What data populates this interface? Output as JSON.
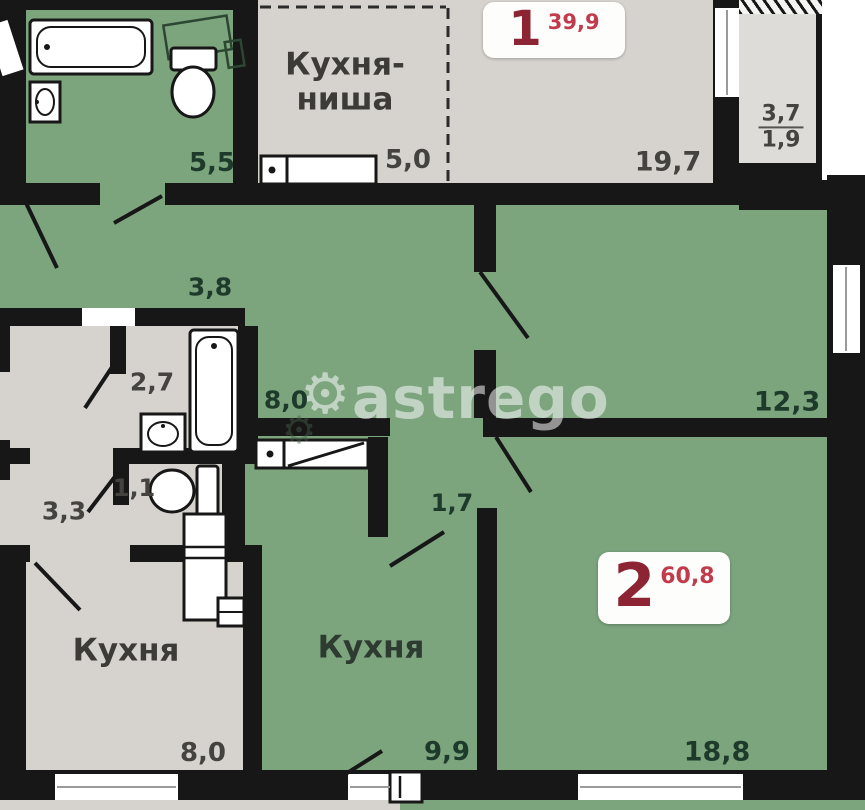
{
  "plan_type": "apartment-floor-plan",
  "apartments": {
    "apt1": {
      "number": "1",
      "area": "39,9"
    },
    "apt2": {
      "number": "2",
      "area": "60,8"
    }
  },
  "rooms": {
    "bath_top": {
      "area": "5,5"
    },
    "kitchen_niche": {
      "label": "Кухня-ниша",
      "area": "5,0"
    },
    "living_197": {
      "area": "19,7"
    },
    "balcony": {
      "area_top": "3,7",
      "area_bottom": "1,9"
    },
    "hall_38": {
      "area": "3,8"
    },
    "bath_27": {
      "area": "2,7"
    },
    "hall_80": {
      "area": "8,0"
    },
    "room_123": {
      "area": "12,3"
    },
    "hall_33": {
      "area": "3,3"
    },
    "wc_11": {
      "area": "1,1"
    },
    "corridor_17": {
      "area": "1,7"
    },
    "kitchen_left": {
      "label": "Кухня",
      "area": "8,0"
    },
    "kitchen_mid": {
      "label": "Кухня",
      "area": "9,9"
    },
    "room_188": {
      "area": "18,8"
    }
  },
  "watermark": {
    "text": "astrego",
    "gear_icon": "⚙"
  },
  "colors": {
    "room_green": "#7ca57e",
    "room_gray": "#d6d3ce",
    "balcony_gray": "#dedcd8",
    "wall_black": "#171717",
    "apartment_number_red": "#8d2433",
    "apartment_area_red": "#c23b4c",
    "label_green_room": "#1e3a2a",
    "label_gray_room": "#44433f"
  }
}
